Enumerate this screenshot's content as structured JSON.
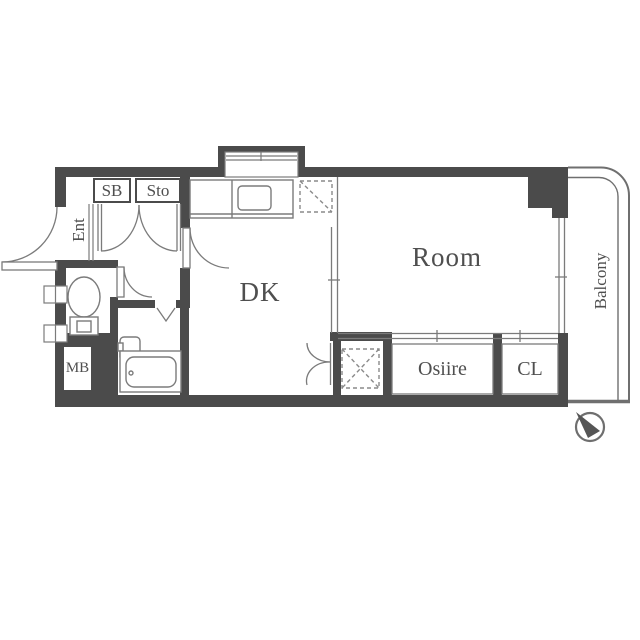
{
  "floorplan": {
    "title": "1DK apartment floor plan",
    "labels": {
      "storage_box": "SB",
      "storage": "Sto",
      "entrance": "Ent",
      "meter_box": "MB",
      "dining_kitchen": "DK",
      "room": "Room",
      "closet_osiire": "Osiire",
      "closet_cl": "CL",
      "balcony": "Balcony"
    },
    "icons": {
      "compass": "north-arrow pointing upper-left",
      "toilet": "toilet bowl with tank",
      "bathtub": "unit bath with tub and sink",
      "stove": "kitchen counter with stove",
      "fridge_space": "dashed square with single diagonal",
      "washer_space": "dashed square with X"
    },
    "colors": {
      "wall": "#4b4b4b",
      "line": "#7b7b7b",
      "dash": "#8a8a8a",
      "text": "#4f4f4f",
      "background": "#ffffff"
    }
  }
}
